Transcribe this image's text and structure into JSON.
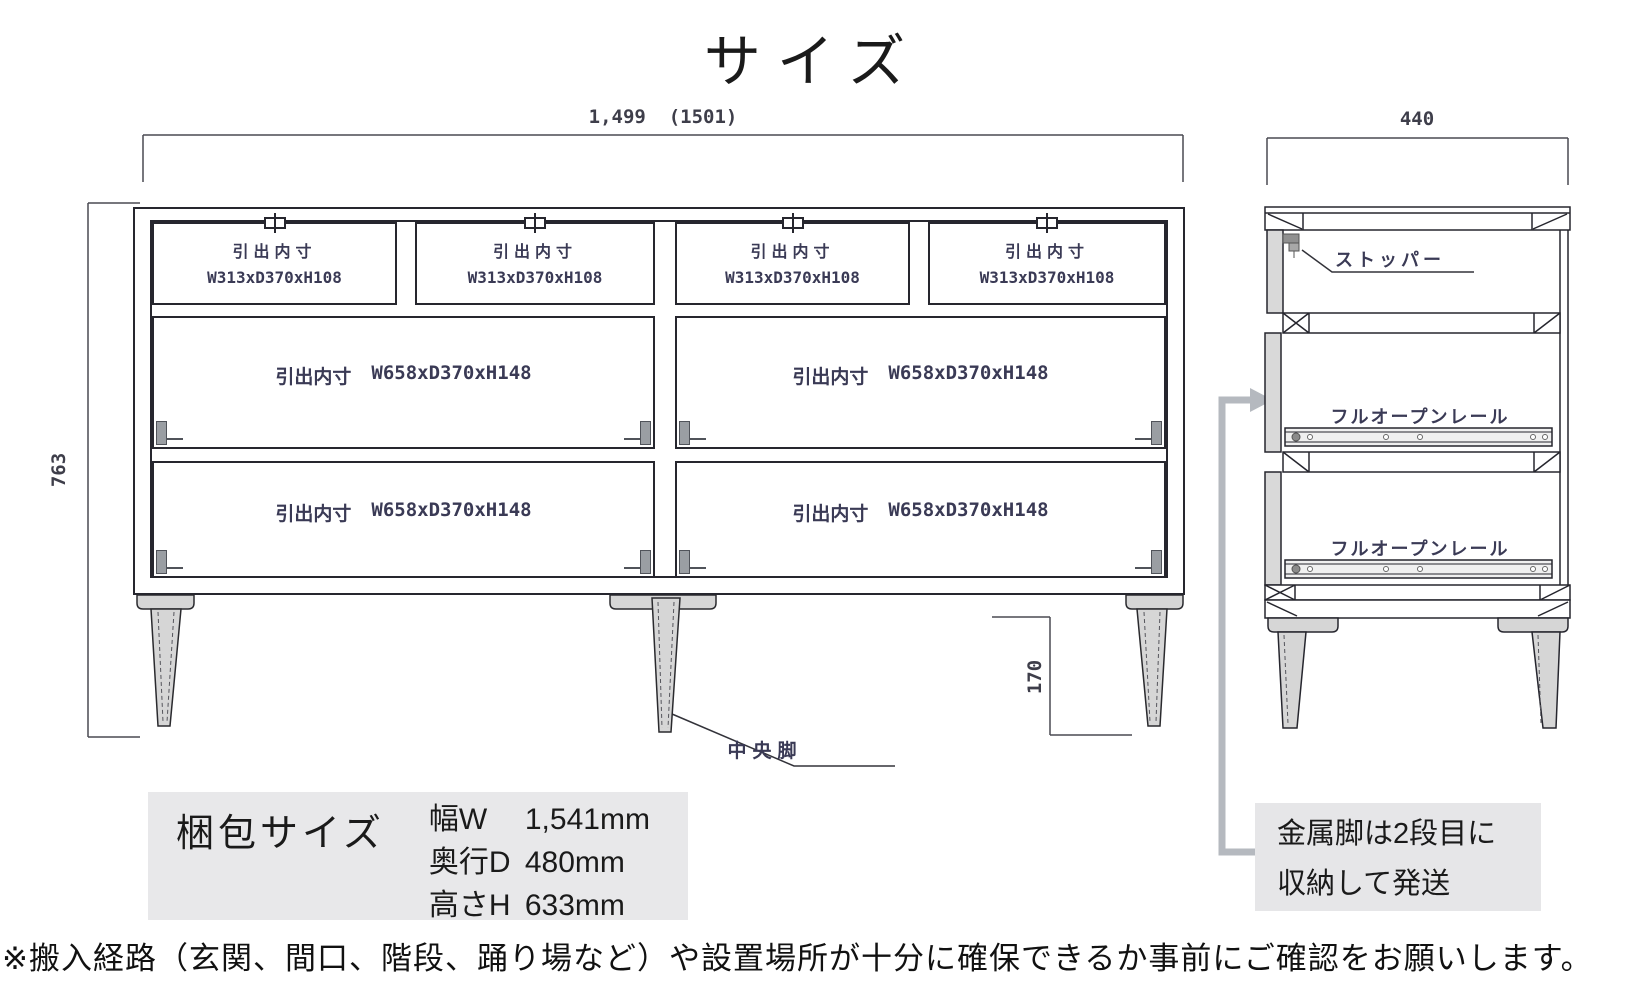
{
  "title": "サイズ",
  "front_view": {
    "width_dim": "1,499  (1501)",
    "height_dim": "763",
    "leg_height_dim": "170",
    "center_leg_label": "中央脚",
    "small_drawers": [
      {
        "title": "引出内寸",
        "size": "W313xD370xH108"
      },
      {
        "title": "引出内寸",
        "size": "W313xD370xH108"
      },
      {
        "title": "引出内寸",
        "size": "W313xD370xH108"
      },
      {
        "title": "引出内寸",
        "size": "W313xD370xH108"
      }
    ],
    "large_drawers": [
      {
        "label": "引出内寸",
        "size": "W658xD370xH148"
      },
      {
        "label": "引出内寸",
        "size": "W658xD370xH148"
      },
      {
        "label": "引出内寸",
        "size": "W658xD370xH148"
      },
      {
        "label": "引出内寸",
        "size": "W658xD370xH148"
      }
    ]
  },
  "side_view": {
    "depth_dim": "440",
    "stopper_label": "ストッパー",
    "rails": [
      {
        "label": "フルオープンレール"
      },
      {
        "label": "フルオープンレール"
      }
    ]
  },
  "packing": {
    "title": "梱包サイズ",
    "rows": [
      {
        "label": "幅W",
        "value": "1,541mm"
      },
      {
        "label": "奥行D",
        "value": "480mm"
      },
      {
        "label": "高さH",
        "value": "633mm"
      }
    ]
  },
  "shipping_note": {
    "line1": "金属脚は2段目に",
    "line2": "収納して発送"
  },
  "footer_note": "※搬入経路（玄関、間口、階段、踊り場など）や設置場所が十分に確保できるか事前にご確認をお願いします。",
  "colors": {
    "cad_text": "#3a3a55",
    "line": "#26262e",
    "callout_grey": "#b5b9bf",
    "info_box_bg": "#e8e8ea",
    "leg_fill": "#d6d6d6"
  }
}
